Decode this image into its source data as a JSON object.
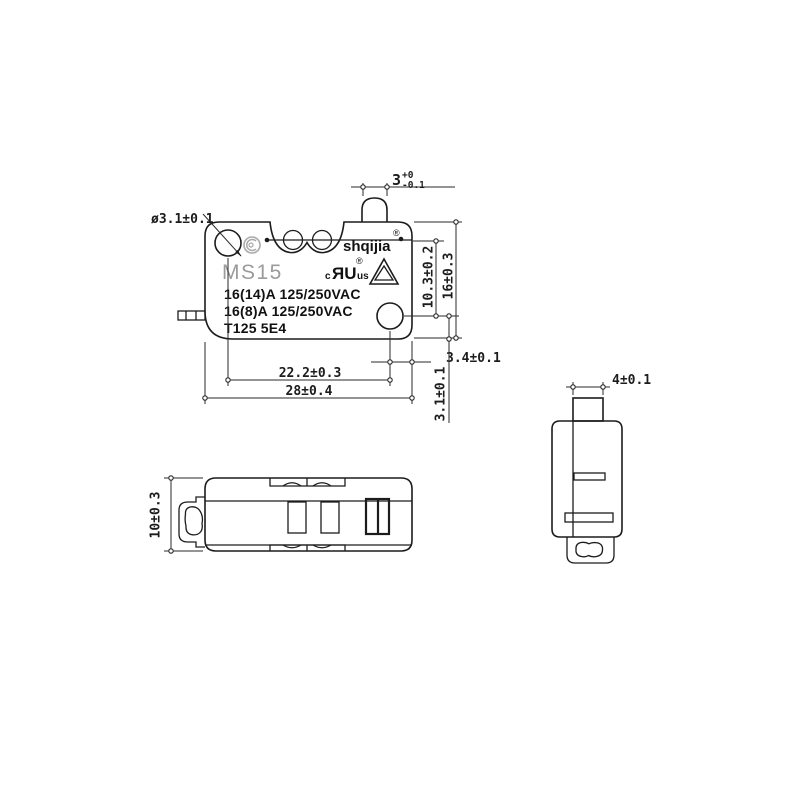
{
  "colors": {
    "line": "#1c1c1c",
    "model_gray": "#9b9b9b",
    "logo_gray": "#a9a9a9"
  },
  "front_view": {
    "model": "MS15",
    "rating_line1": "16(14)A  125/250VAC",
    "rating_line2": "16(8)A  125/250VAC",
    "rating_line3": "T125  5E4",
    "brand": "shqijia",
    "brand_reg": "®",
    "ul": {
      "c": "c",
      "ru": "ЯU",
      "reg": "®",
      "us": "us"
    },
    "dims": {
      "hole_dia": "ø3.1±0.1",
      "plunger_nominal": "3",
      "plunger_upper": "+0",
      "plunger_lower": "-0.1",
      "slot_to_hole": "10.3±0.2",
      "height": "16±0.3",
      "hole_to_edge_h": "3.4±0.1",
      "hole_to_edge_v": "3.1±0.1",
      "hole_spacing": "22.2±0.3",
      "length": "28±0.4"
    }
  },
  "bottom_view": {
    "dims": {
      "width": "10±0.3"
    }
  },
  "side_view": {
    "dims": {
      "plunger_width": "4±0.1"
    }
  },
  "icons": {
    "ccc_logo": "ccc-certification-logo",
    "ul_mark": "ul-recognized-component-mark",
    "triangle_mark": "triangle-certification-mark"
  }
}
